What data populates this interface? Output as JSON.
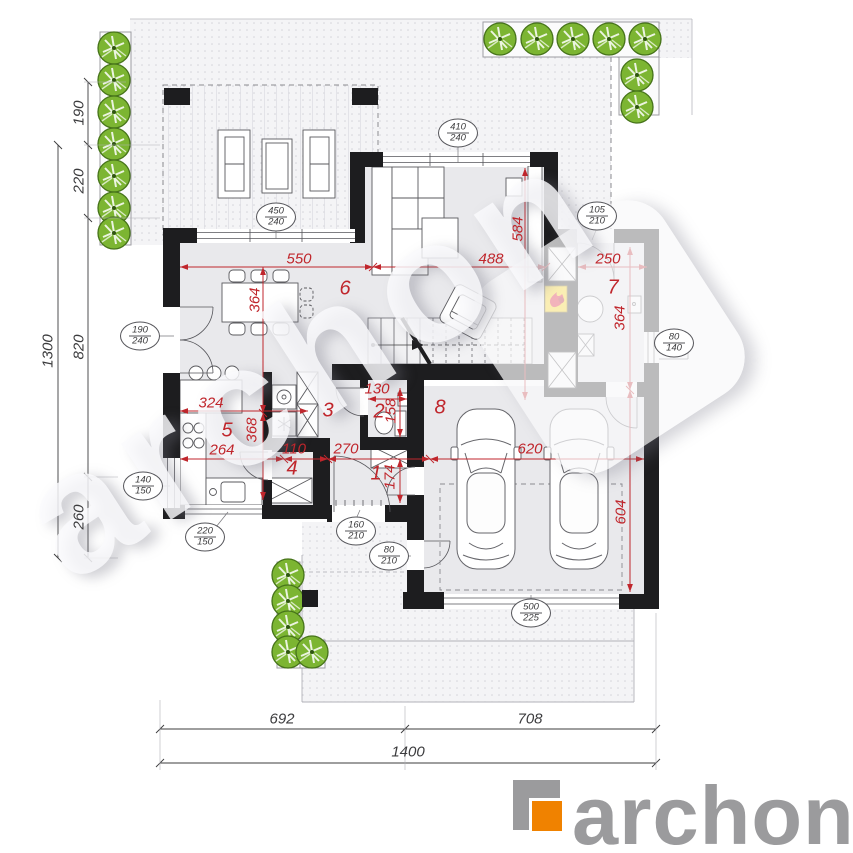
{
  "colors": {
    "dimension_red": "#c0262c",
    "wall_black": "#1d1d1f",
    "tree_green": "#7cb532",
    "logo_orange": "#f08200",
    "logo_gray": "#9b9b9d",
    "fireplace_yellow": "#ffd500",
    "flame_red": "#e2001a",
    "floor_gray": "#e9e9ec"
  },
  "rooms": [
    "1",
    "2",
    "3",
    "4",
    "5",
    "6",
    "7",
    "8"
  ],
  "red_dims": {
    "d550": "550",
    "d488": "488",
    "d250": "250",
    "d364a": "364",
    "d368": "368",
    "d584": "584",
    "d364b": "364",
    "d604": "604",
    "d324": "324",
    "d264": "264",
    "d110": "110",
    "d270": "270",
    "d174": "174",
    "d620": "620",
    "d130": "130",
    "d158": "158"
  },
  "site_dims": {
    "left": [
      "190",
      "220",
      "820",
      "260"
    ],
    "left_total": "1300",
    "bottom_left": "692",
    "bottom_right": "708",
    "bottom_total": "1400"
  },
  "bubbles": [
    {
      "w": "410",
      "h": "240"
    },
    {
      "w": "450",
      "h": "240"
    },
    {
      "w": "190",
      "h": "240"
    },
    {
      "w": "140",
      "h": "150"
    },
    {
      "w": "220",
      "h": "150"
    },
    {
      "w": "160",
      "h": "210"
    },
    {
      "w": "80",
      "h": "210"
    },
    {
      "w": "500",
      "h": "225"
    },
    {
      "w": "105",
      "h": "210"
    },
    {
      "w": "80",
      "h": "140"
    }
  ],
  "watermark": {
    "text": "archon"
  },
  "logo": {
    "text": "archon"
  }
}
